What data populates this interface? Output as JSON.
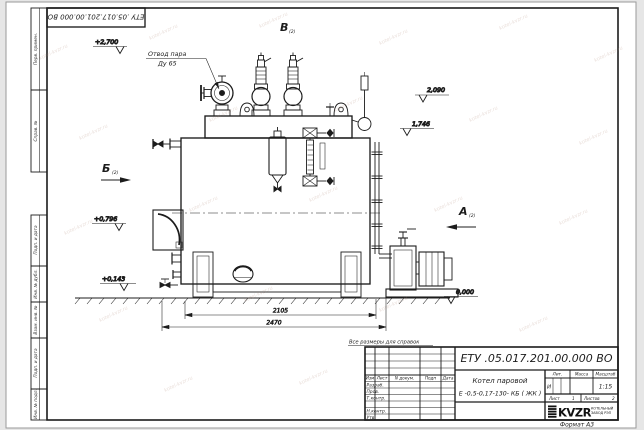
{
  "page": {
    "watermark": "kotel-kvzr.ru",
    "format_label": "Формат А3",
    "reference_note": "Все размеры для справок",
    "corner_stamp": "ЕТУ .05.017.201.00.000  ВО"
  },
  "margin_labels": {
    "perv_primen": "Перв. примен.",
    "sprav_no": "Справ. №",
    "podp_data_1": "Подп. и дата",
    "inv_no_dubl": "Инв. № дубл.",
    "vzam_inv_no": "Взам. инв. №",
    "podp_data_2": "Подп. и дата",
    "inv_no_podl": "Инв. № подл."
  },
  "drawing": {
    "callout_line1": "Отвод пара",
    "callout_line2": "Ду 65",
    "elev_2700": "+2,700",
    "elev_2090": "2,090",
    "elev_1746": "1,746",
    "elev_0796": "+0,796",
    "elev_0143": "+0,143",
    "elev_0000": "0,000",
    "dim_2105": "2105",
    "dim_2470": "2470",
    "view_a": "А",
    "view_b": "Б",
    "view_v": "В",
    "view_sheet_ref": "(2)"
  },
  "title_block": {
    "designation": "ЕТУ .05.017.201.00.000  ВО",
    "product_name": "Котел паровой",
    "product_code": "Е -0,5-0,17-130- КБ ( ЖК )",
    "col_izm": "Изм",
    "col_list": "Лист",
    "col_ndokum": "N докум.",
    "col_podp": "Подп",
    "col_data": "Дата",
    "row_razrab": "Разраб.",
    "row_prov": "Пров.",
    "row_tkontr": "Т.контр.",
    "row_nkontr": "Н.контр.",
    "row_utv": "Утв.",
    "lit_header": "Лит.",
    "massa_header": "Масса",
    "masshtab_header": "Масштаб",
    "lit_value": "И",
    "scale_value": "1:15",
    "sheet_label": "Лист",
    "sheet_number": "1",
    "sheets_label": "Листов",
    "sheets_total": "2",
    "logo_text": "KVZR",
    "logo_caption1": "КОТЕЛЬНЫЙ",
    "logo_caption2": "ЗАВОД РЭП"
  }
}
